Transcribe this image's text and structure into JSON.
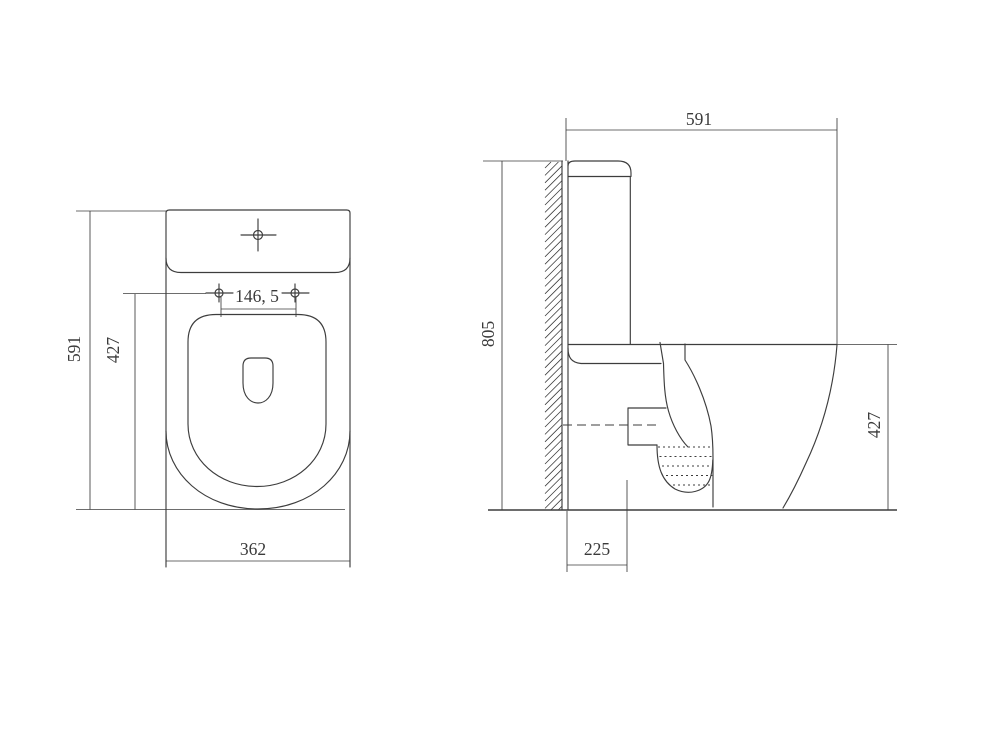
{
  "drawing": {
    "kind": "toilet-dimension-drawing",
    "plan_view": {
      "overall_depth": "591",
      "bowl_depth": "427",
      "seat_hole_spacing": "146, 5",
      "overall_width": "362"
    },
    "side_view": {
      "overall_depth": "591",
      "overall_height": "805",
      "rim_height": "427",
      "outlet_setout": "225"
    },
    "colors": {
      "line": "#3d3d3d",
      "text": "#3a3a3a",
      "background": "#ffffff"
    }
  }
}
